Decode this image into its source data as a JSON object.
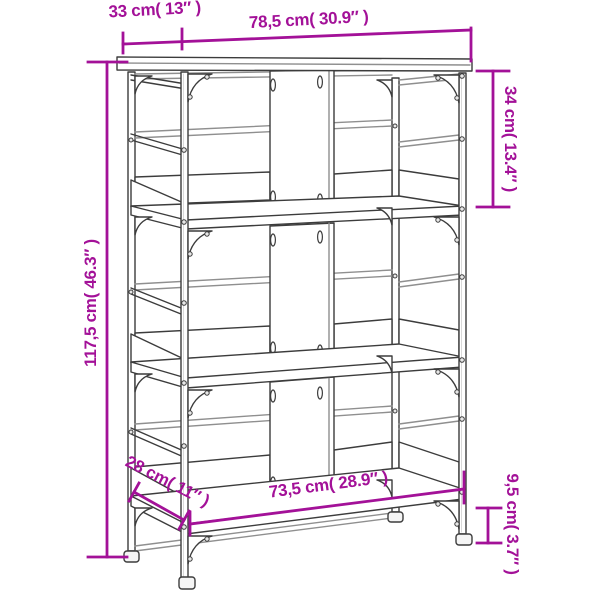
{
  "diagram": {
    "background_color": "#ffffff",
    "line_color": "#3c3c3c",
    "light_line_color": "#8f8f8f",
    "accent_color": "#a31198",
    "dimensions": {
      "top_depth": {
        "label": "33 cm( 13″ )"
      },
      "width": {
        "label": "78,5 cm( 30.9″ )"
      },
      "upper_height": {
        "label": "34 cm( 13.4″ )"
      },
      "total_height": {
        "label": "117,5 cm( 46.3″ )"
      },
      "bottom_depth": {
        "label": "28 cm( 11″ )"
      },
      "bottom_width": {
        "label": "73,5 cm( 28.9″ )"
      },
      "foot_height": {
        "label": "9,5 cm( 3.7″ )"
      }
    }
  }
}
